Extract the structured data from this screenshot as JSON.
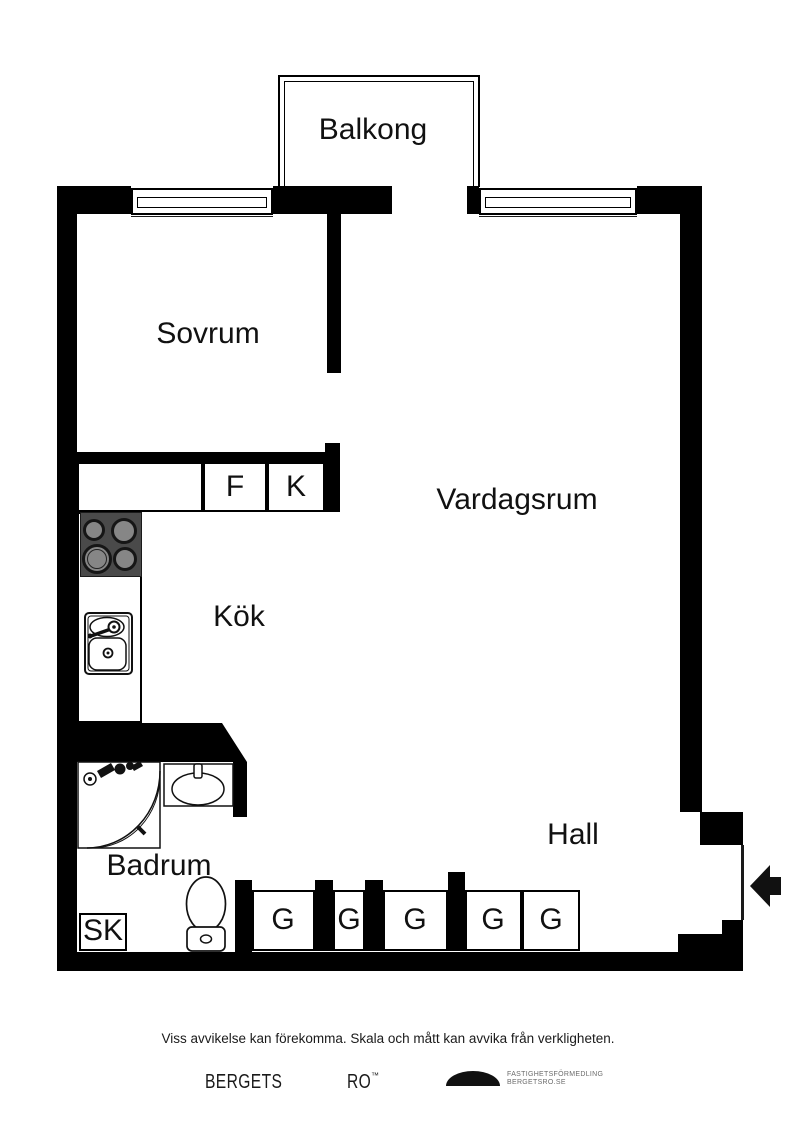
{
  "rooms": {
    "balcony": "Balkong",
    "bedroom": "Sovrum",
    "living_room": "Vardagsrum",
    "kitchen": "Kök",
    "bathroom": "Badrum",
    "hall": "Hall"
  },
  "closets": {
    "f": "F",
    "k": "K",
    "sk": "SK",
    "g": "G"
  },
  "footer": {
    "disclaimer": "Viss avvikelse kan förekomma. Skala och mått kan avvika från verkligheten."
  },
  "brand": {
    "word_left": "BERGETS",
    "word_right": "RO",
    "trademark": "™",
    "tagline_line1": "FASTIGHETSFÖRMEDLING",
    "tagline_line2": "BERGETSRO.SE"
  },
  "colors": {
    "background": "#ffffff",
    "wall": "#000000",
    "stove_body": "#4a4a4a",
    "burner_center": "#868686",
    "label_text": "#111111",
    "tagline_text": "#6b6b6b"
  }
}
